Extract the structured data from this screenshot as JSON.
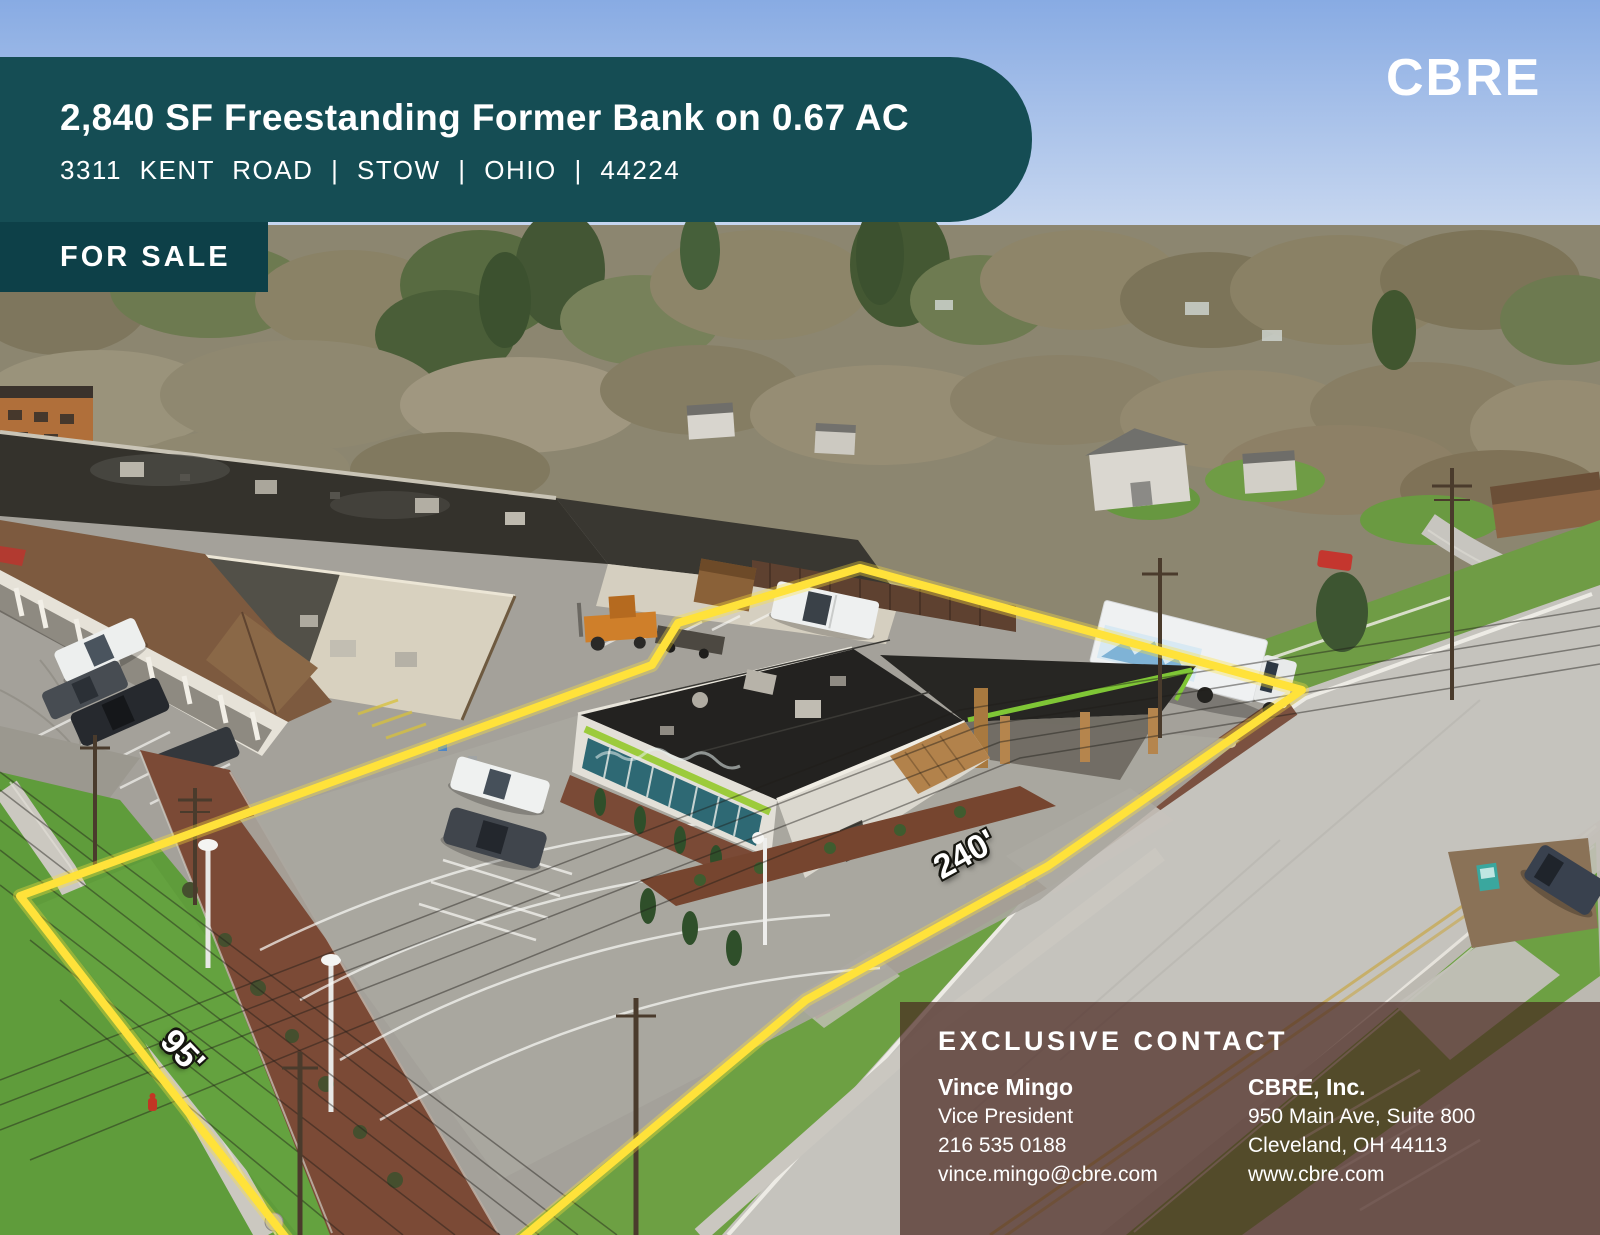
{
  "flyer": {
    "title": "2,840 SF Freestanding Former Bank on 0.67 AC",
    "address": "3311 KENT ROAD | STOW | OHIO | 44224",
    "badge": "FOR SALE",
    "brand_logo": "CBRE"
  },
  "boundary_labels": {
    "frontage": "240'",
    "depth": "95'"
  },
  "contact": {
    "heading": "EXCLUSIVE CONTACT",
    "agent_name": "Vince Mingo",
    "agent_title": "Vice President",
    "agent_phone": "216 535 0188",
    "agent_email": "vince.mingo@cbre.com",
    "company_name": "CBRE, Inc.",
    "company_address1": "950 Main Ave, Suite 800",
    "company_address2": "Cleveland, OH 44113",
    "company_web": "www.cbre.com"
  },
  "colors": {
    "banner_teal": "#154d54",
    "badge_teal": "#0d4048",
    "boundary_yellow": "#ffe23a",
    "building_accent_green": "#9ccb3c",
    "contact_overlay": "rgba(72,38,31,0.7)"
  }
}
